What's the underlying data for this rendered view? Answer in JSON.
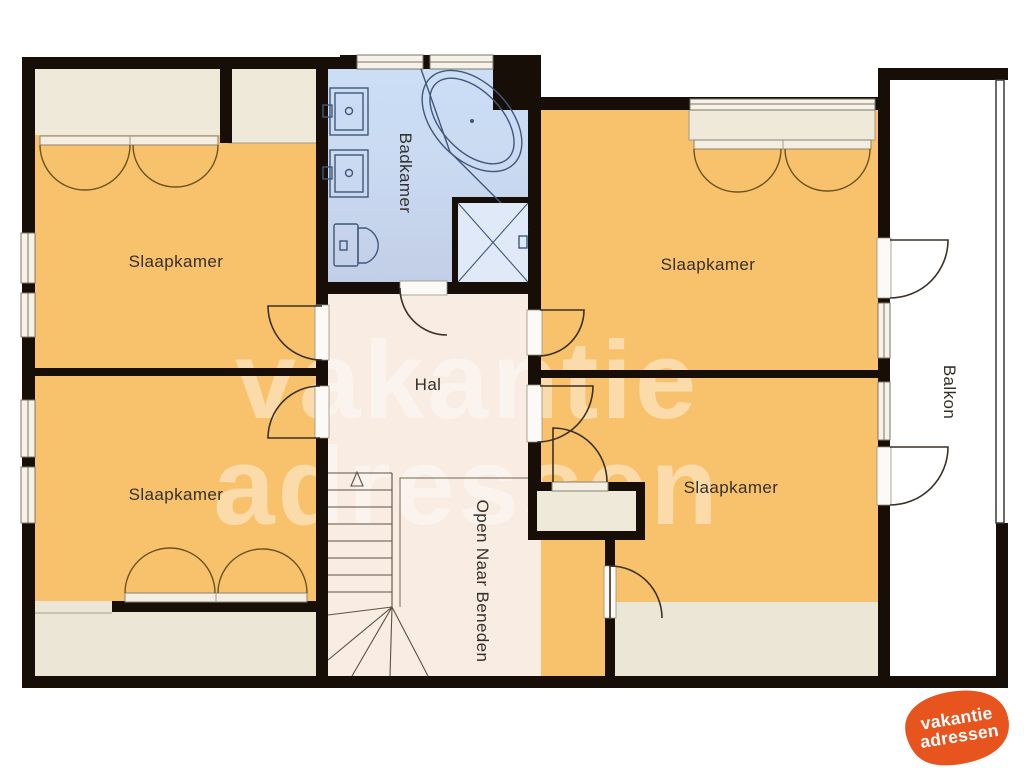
{
  "plan": {
    "type": "floorplan-upper-floor",
    "rooms": {
      "bedroom_tl": "Slaapkamer",
      "bedroom_tr": "Slaapkamer",
      "bedroom_bl": "Slaapkamer",
      "bedroom_br": "Slaapkamer",
      "bathroom": "Badkamer",
      "hall": "Hal",
      "balcony": "Balkon",
      "stair_void": "Open Naar Beneden"
    }
  },
  "watermark": {
    "line1": "vakantie",
    "line2": "adressen"
  },
  "logo": {
    "line1": "vakantie",
    "line2": "adressen"
  },
  "colors": {
    "wall": "#170e08",
    "bedroom": "#f8c26d",
    "hall": "#f9ece2",
    "bathroom_top": "#cbdef5",
    "bathroom_bottom": "#c3cee7",
    "closet": "#efe9d9",
    "balcony": "#ffffff",
    "logo_orange": "#e8541d"
  }
}
